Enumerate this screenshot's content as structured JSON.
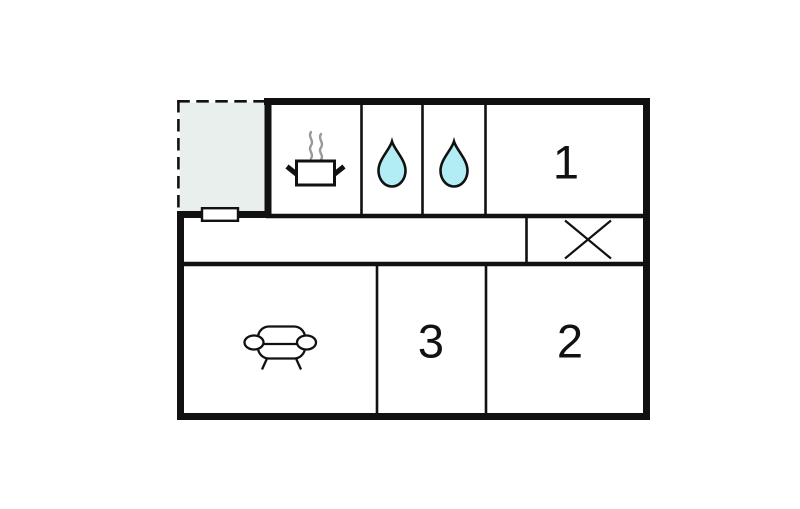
{
  "colors": {
    "background": "#ffffff",
    "wall": "#111111",
    "terrace_fill": "#e8efec",
    "water_drop_fill": "#b2ecf4",
    "steam": "#999999"
  },
  "rooms": {
    "bedroom_1": {
      "number": "1"
    },
    "bedroom_2": {
      "number": "2"
    },
    "bedroom_3": {
      "number": "3"
    },
    "kitchen": {
      "icon": "cooking-pot-icon"
    },
    "bathroom_left": {
      "icon": "water-drop-icon"
    },
    "bathroom_right": {
      "icon": "water-drop-icon"
    },
    "living_room": {
      "icon": "sofa-icon"
    },
    "stairwell": {
      "icon": "crossed-box-icon"
    },
    "terrace": {
      "icon": "none"
    }
  }
}
